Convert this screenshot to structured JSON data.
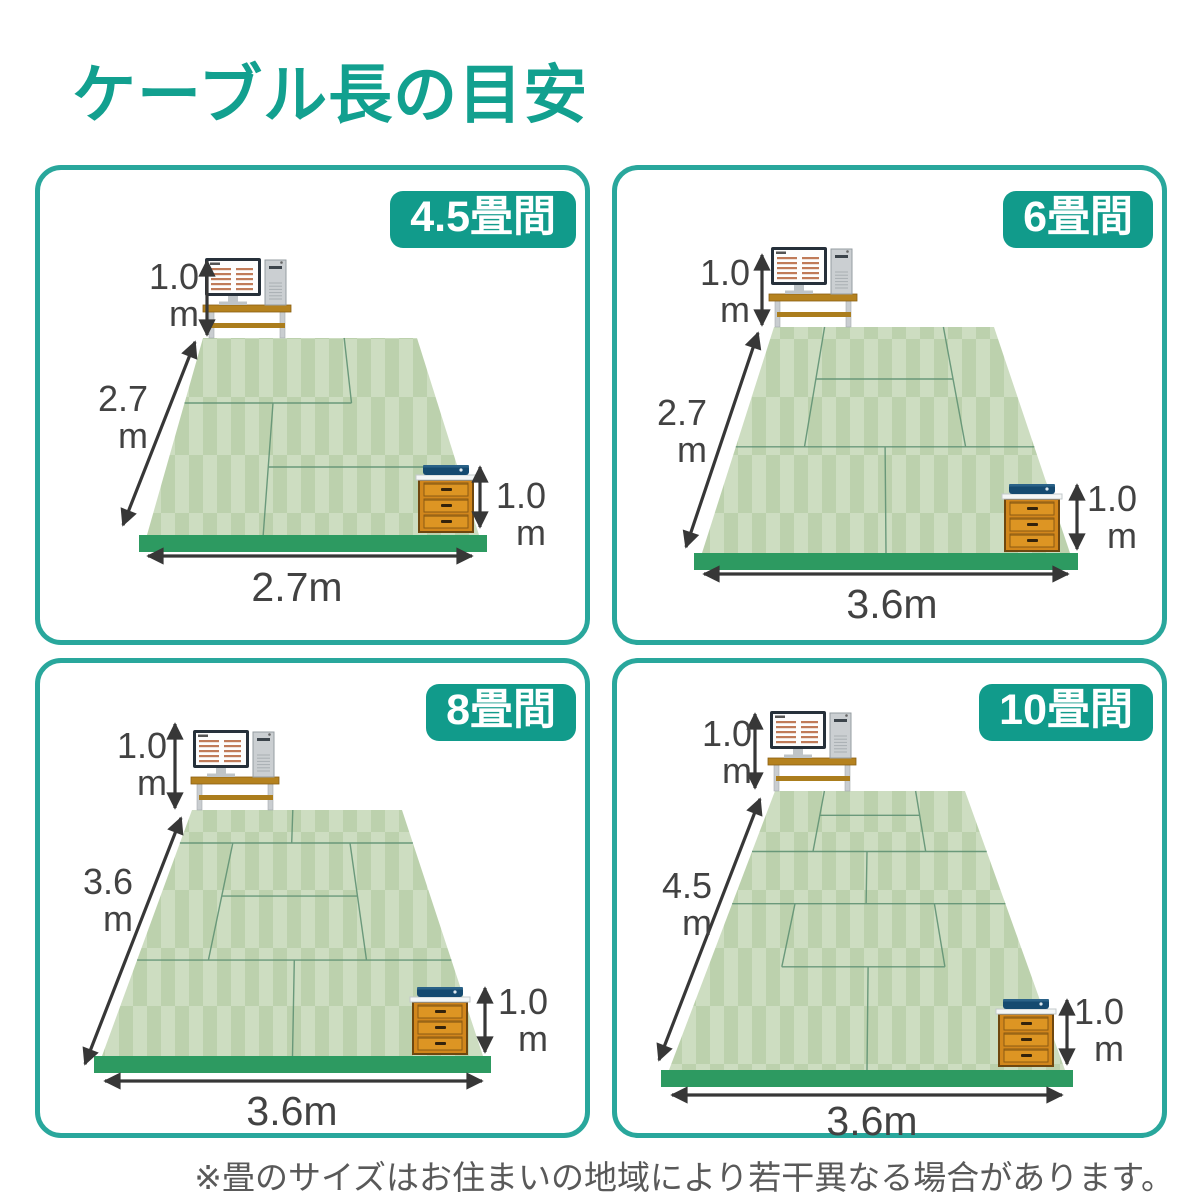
{
  "title": "ケーブル長の目安",
  "footnote": "※畳のサイズはお住まいの地域により若干異なる場合があります。",
  "panels": [
    {
      "badge": "4.5畳間",
      "desk_height": {
        "value": "1.0",
        "unit": "m"
      },
      "room_depth": {
        "value": "2.7",
        "unit": "m"
      },
      "cabinet_height": {
        "value": "1.0",
        "unit": "m"
      },
      "room_width": "2.7m"
    },
    {
      "badge": "6畳間",
      "desk_height": {
        "value": "1.0",
        "unit": "m"
      },
      "room_depth": {
        "value": "2.7",
        "unit": "m"
      },
      "cabinet_height": {
        "value": "1.0",
        "unit": "m"
      },
      "room_width": "3.6m"
    },
    {
      "badge": "8畳間",
      "desk_height": {
        "value": "1.0",
        "unit": "m"
      },
      "room_depth": {
        "value": "3.6",
        "unit": "m"
      },
      "cabinet_height": {
        "value": "1.0",
        "unit": "m"
      },
      "room_width": "3.6m"
    },
    {
      "badge": "10畳間",
      "desk_height": {
        "value": "1.0",
        "unit": "m"
      },
      "room_depth": {
        "value": "4.5",
        "unit": "m"
      },
      "cabinet_height": {
        "value": "1.0",
        "unit": "m"
      },
      "room_width": "3.6m"
    }
  ],
  "colors": {
    "accent_teal": "#12a08f",
    "panel_border": "#29a79c",
    "badge_bg": "#119b8b",
    "tatami_light": "#cdddc1",
    "tatami_dark": "#bcd1ad",
    "mat_line": "#5f9173",
    "floor_edge_green": "#2d9a61",
    "desk_wood": "#b5821f",
    "cabinet_orange": "#d2871c",
    "router_navy": "#154a70",
    "dimension_text": "#424242",
    "arrow": "#373737",
    "note_text": "#595959"
  }
}
